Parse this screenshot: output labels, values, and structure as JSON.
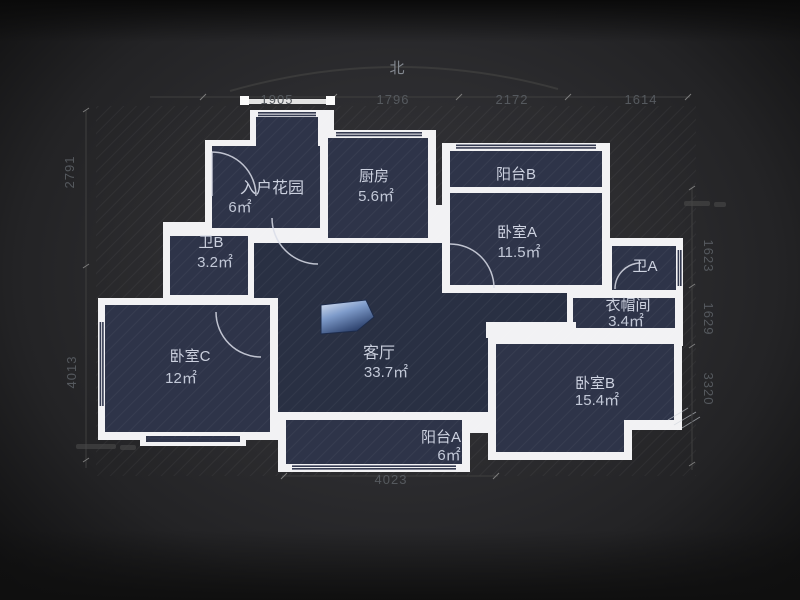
{
  "compass": {
    "north_label": "北"
  },
  "rooms": [
    {
      "name": "入户花园",
      "area": "6㎡"
    },
    {
      "name": "厨房",
      "area": "5.6㎡"
    },
    {
      "name": "阳台B",
      "area": ""
    },
    {
      "name": "卧室A",
      "area": "11.5㎡"
    },
    {
      "name": "卫B",
      "area": "3.2㎡"
    },
    {
      "name": "卫A",
      "area": ""
    },
    {
      "name": "衣帽间",
      "area": "3.4㎡"
    },
    {
      "name": "卧室C",
      "area": "12㎡"
    },
    {
      "name": "客厅",
      "area": "33.7㎡"
    },
    {
      "name": "卧室B",
      "area": "15.4㎡"
    },
    {
      "name": "阳台A",
      "area": "6㎡"
    }
  ],
  "dimensions": {
    "top": [
      "1905",
      "1796",
      "2172",
      "1614"
    ],
    "left": [
      "2791",
      "4013"
    ],
    "right": [
      "1623",
      "1629",
      "3320"
    ],
    "bottom": [
      "4023"
    ]
  },
  "colors": {
    "wall": "#f2f2f4",
    "room_fill": "#2e3449",
    "living_fill": "#293043",
    "background": "#2c2c2f",
    "door_marker_blue": "#7f9ccb",
    "dimension_text": "#55595e",
    "label_text": "#ccd1df"
  }
}
